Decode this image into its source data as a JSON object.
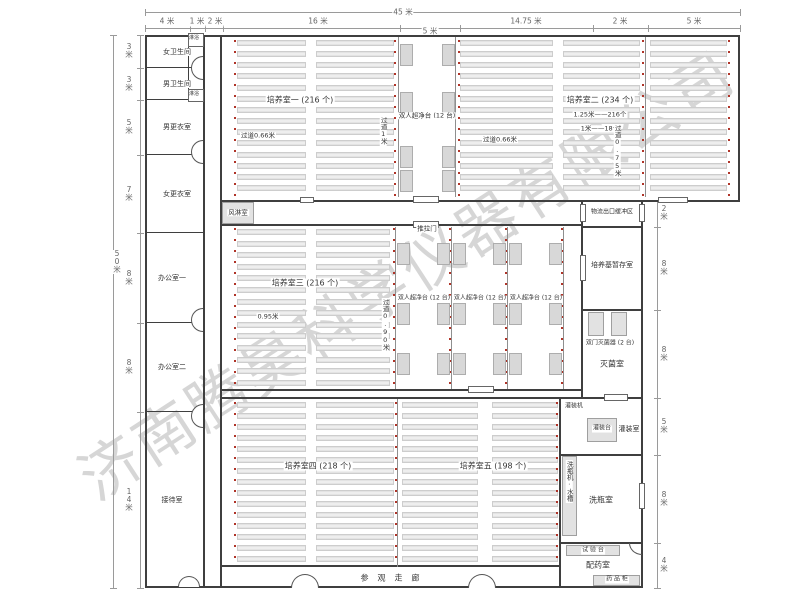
{
  "watermark": "济南腾昊科学仪器有限公司",
  "dimensions": {
    "total_width": "45 米",
    "total_height": "50米",
    "top": [
      "4 米",
      "1 米",
      "2 米",
      "16 米",
      "5 米",
      "14.75 米",
      "2 米",
      "5 米"
    ],
    "left": [
      "3米",
      "3米",
      "5米",
      "7米",
      "8米",
      "8米",
      "14米"
    ],
    "right": [
      "2米",
      "8米",
      "8米",
      "5米",
      "8米",
      "4米"
    ]
  },
  "left_wing": {
    "rooms": [
      "女卫生间",
      "男卫生间",
      "男更衣室",
      "女更衣室",
      "办公室一",
      "办公室二",
      "接待室"
    ],
    "shower": "淋浴"
  },
  "culture_rooms": {
    "r1": {
      "label": "培养室一 (216 个)",
      "aisle": "过道0.66米",
      "aisle_v": "过道1米"
    },
    "r2": {
      "label": "培养室二 (234 个)",
      "spec1": "1.25米——216个",
      "spec2": "1米——18个",
      "aisle": "过道0.66米",
      "aisle_v": "过道0.75米"
    },
    "r3": {
      "label": "培养室三 (216 个)",
      "note": "0.95米",
      "aisle_v": "过道0.90米"
    },
    "r4": {
      "label": "培养室四 (218 个)"
    },
    "r5": {
      "label": "培养室五 (198 个)"
    }
  },
  "equipment": {
    "clean_bench": "双人超净台 (12 台)",
    "air_shower": "风淋室",
    "sliding_door": "推拉门",
    "sterilizer": "双门灭菌器 (2 台)",
    "filling_machine": "灌装机",
    "filling_table": "灌装台",
    "washer_sink": "洗瓶机·水槽",
    "test_bench": "试 验 台",
    "medicine_cabinet": "药 品 柜"
  },
  "right_wing": {
    "buffer": "物流出口缓冲区",
    "medium_storage": "培养基暂存室",
    "sterilization": "灭菌室",
    "filling": "灌装室",
    "washing": "洗瓶室",
    "dispensing": "配药室"
  },
  "corridor": "参观走廊"
}
